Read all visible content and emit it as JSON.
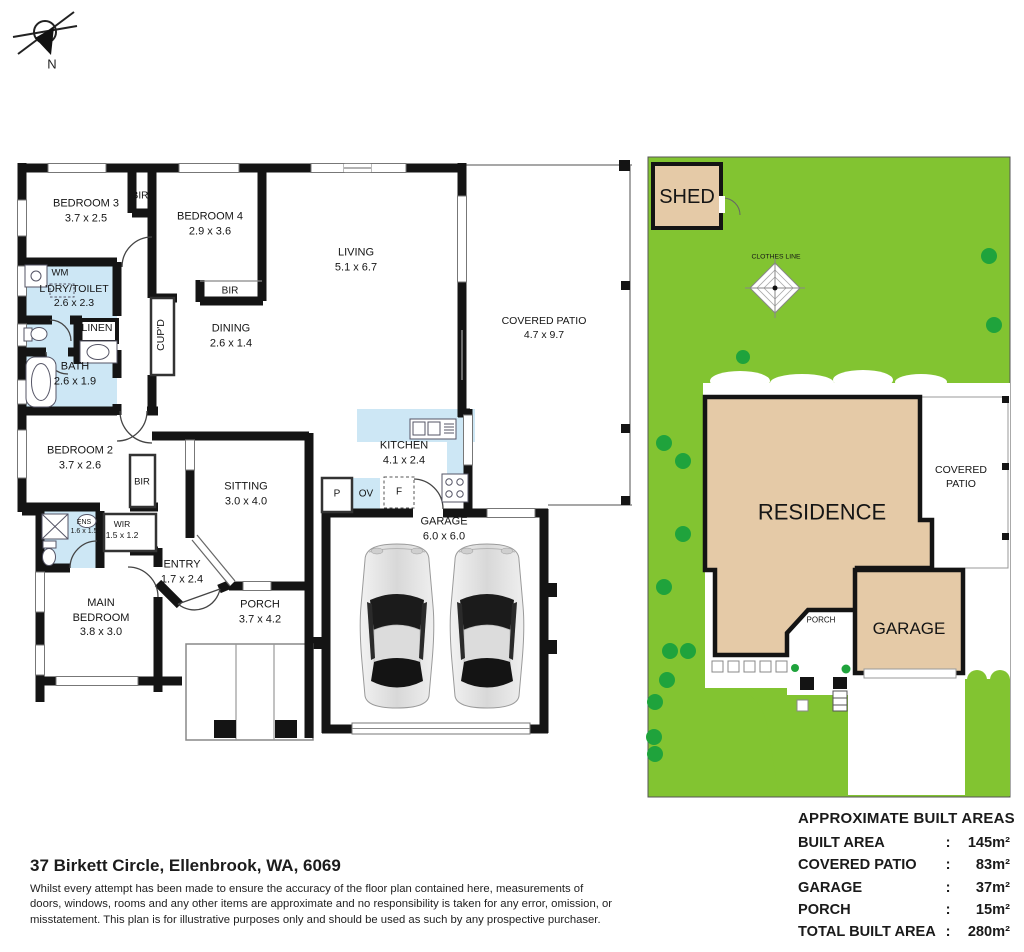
{
  "compass": {
    "label": "N"
  },
  "floorplan": {
    "rooms": [
      {
        "id": "bedroom3",
        "name": "BEDROOM 3",
        "dims": "3.7 x 2.5"
      },
      {
        "id": "bir_top",
        "name": "BIR",
        "dims": ""
      },
      {
        "id": "bedroom4",
        "name": "BEDROOM 4",
        "dims": "2.9 x 3.6"
      },
      {
        "id": "living",
        "name": "LIVING",
        "dims": "5.1 x 6.7"
      },
      {
        "id": "covered_patio",
        "name": "COVERED PATIO",
        "dims": "4.7 x 9.7"
      },
      {
        "id": "wm",
        "name": "WM",
        "dims": ""
      },
      {
        "id": "ldry",
        "name": "L'DRY/TOILET",
        "dims": "2.6 x 2.3"
      },
      {
        "id": "linen",
        "name": "LINEN",
        "dims": ""
      },
      {
        "id": "cupd",
        "name": "CUP'D",
        "dims": ""
      },
      {
        "id": "bir_bed4",
        "name": "BIR",
        "dims": ""
      },
      {
        "id": "dining",
        "name": "DINING",
        "dims": "2.6 x 1.4"
      },
      {
        "id": "bath",
        "name": "BATH",
        "dims": "2.6 x 1.9"
      },
      {
        "id": "bedroom2",
        "name": "BEDROOM 2",
        "dims": "3.7 x 2.6"
      },
      {
        "id": "bir_bed2",
        "name": "BIR",
        "dims": ""
      },
      {
        "id": "sitting",
        "name": "SITTING",
        "dims": "3.0 x 4.0"
      },
      {
        "id": "kitchen",
        "name": "KITCHEN",
        "dims": "4.1 x 2.4"
      },
      {
        "id": "p",
        "name": "P",
        "dims": ""
      },
      {
        "id": "ov",
        "name": "OV",
        "dims": ""
      },
      {
        "id": "f",
        "name": "F",
        "dims": ""
      },
      {
        "id": "garage",
        "name": "GARAGE",
        "dims": "6.0 x 6.0"
      },
      {
        "id": "ens",
        "name": "ENS",
        "dims": "1.6 x 1.5"
      },
      {
        "id": "wir",
        "name": "WIR",
        "dims": "1.5 x 1.2"
      },
      {
        "id": "entry",
        "name": "ENTRY",
        "dims": "1.7 x 2.4"
      },
      {
        "id": "main_bedroom",
        "name": "MAIN\nBEDROOM",
        "dims": "3.8 x 3.0"
      },
      {
        "id": "porch",
        "name": "PORCH",
        "dims": "3.7 x 4.2"
      }
    ]
  },
  "siteplan": {
    "labels": [
      {
        "id": "shed",
        "name": "SHED"
      },
      {
        "id": "clothes_line",
        "name": "CLOTHES LINE"
      },
      {
        "id": "residence",
        "name": "RESIDENCE"
      },
      {
        "id": "covered_patio_sp",
        "name": "COVERED\nPATIO"
      },
      {
        "id": "garage_sp",
        "name": "GARAGE"
      },
      {
        "id": "porch_sp",
        "name": "PORCH"
      }
    ]
  },
  "footer": {
    "address": "37 Birkett Circle, Ellenbrook, WA, 6069",
    "disclaimer": "Whilst every attempt has been made to ensure the accuracy of the floor plan contained here, measurements of doors, windows, rooms and any other items are approximate and no responsibility is taken for any error, omission, or misstatement. This plan is for illustrative purposes only and should be used as such by any prospective purchaser."
  },
  "areas": {
    "title": "APPROXIMATE BUILT AREAS",
    "rows": [
      {
        "label": "BUILT AREA",
        "value": "145m²"
      },
      {
        "label": "COVERED PATIO",
        "value": "83m²"
      },
      {
        "label": "GARAGE",
        "value": "37m²"
      },
      {
        "label": "PORCH",
        "value": "15m²"
      },
      {
        "label": "TOTAL BUILT AREA",
        "value": "280m²"
      }
    ]
  },
  "colors": {
    "lawn": "#82c431",
    "tree": "#1fa33c",
    "building": "#e5caa7",
    "wet_area": "#cde7f5",
    "wall": "#141414"
  }
}
